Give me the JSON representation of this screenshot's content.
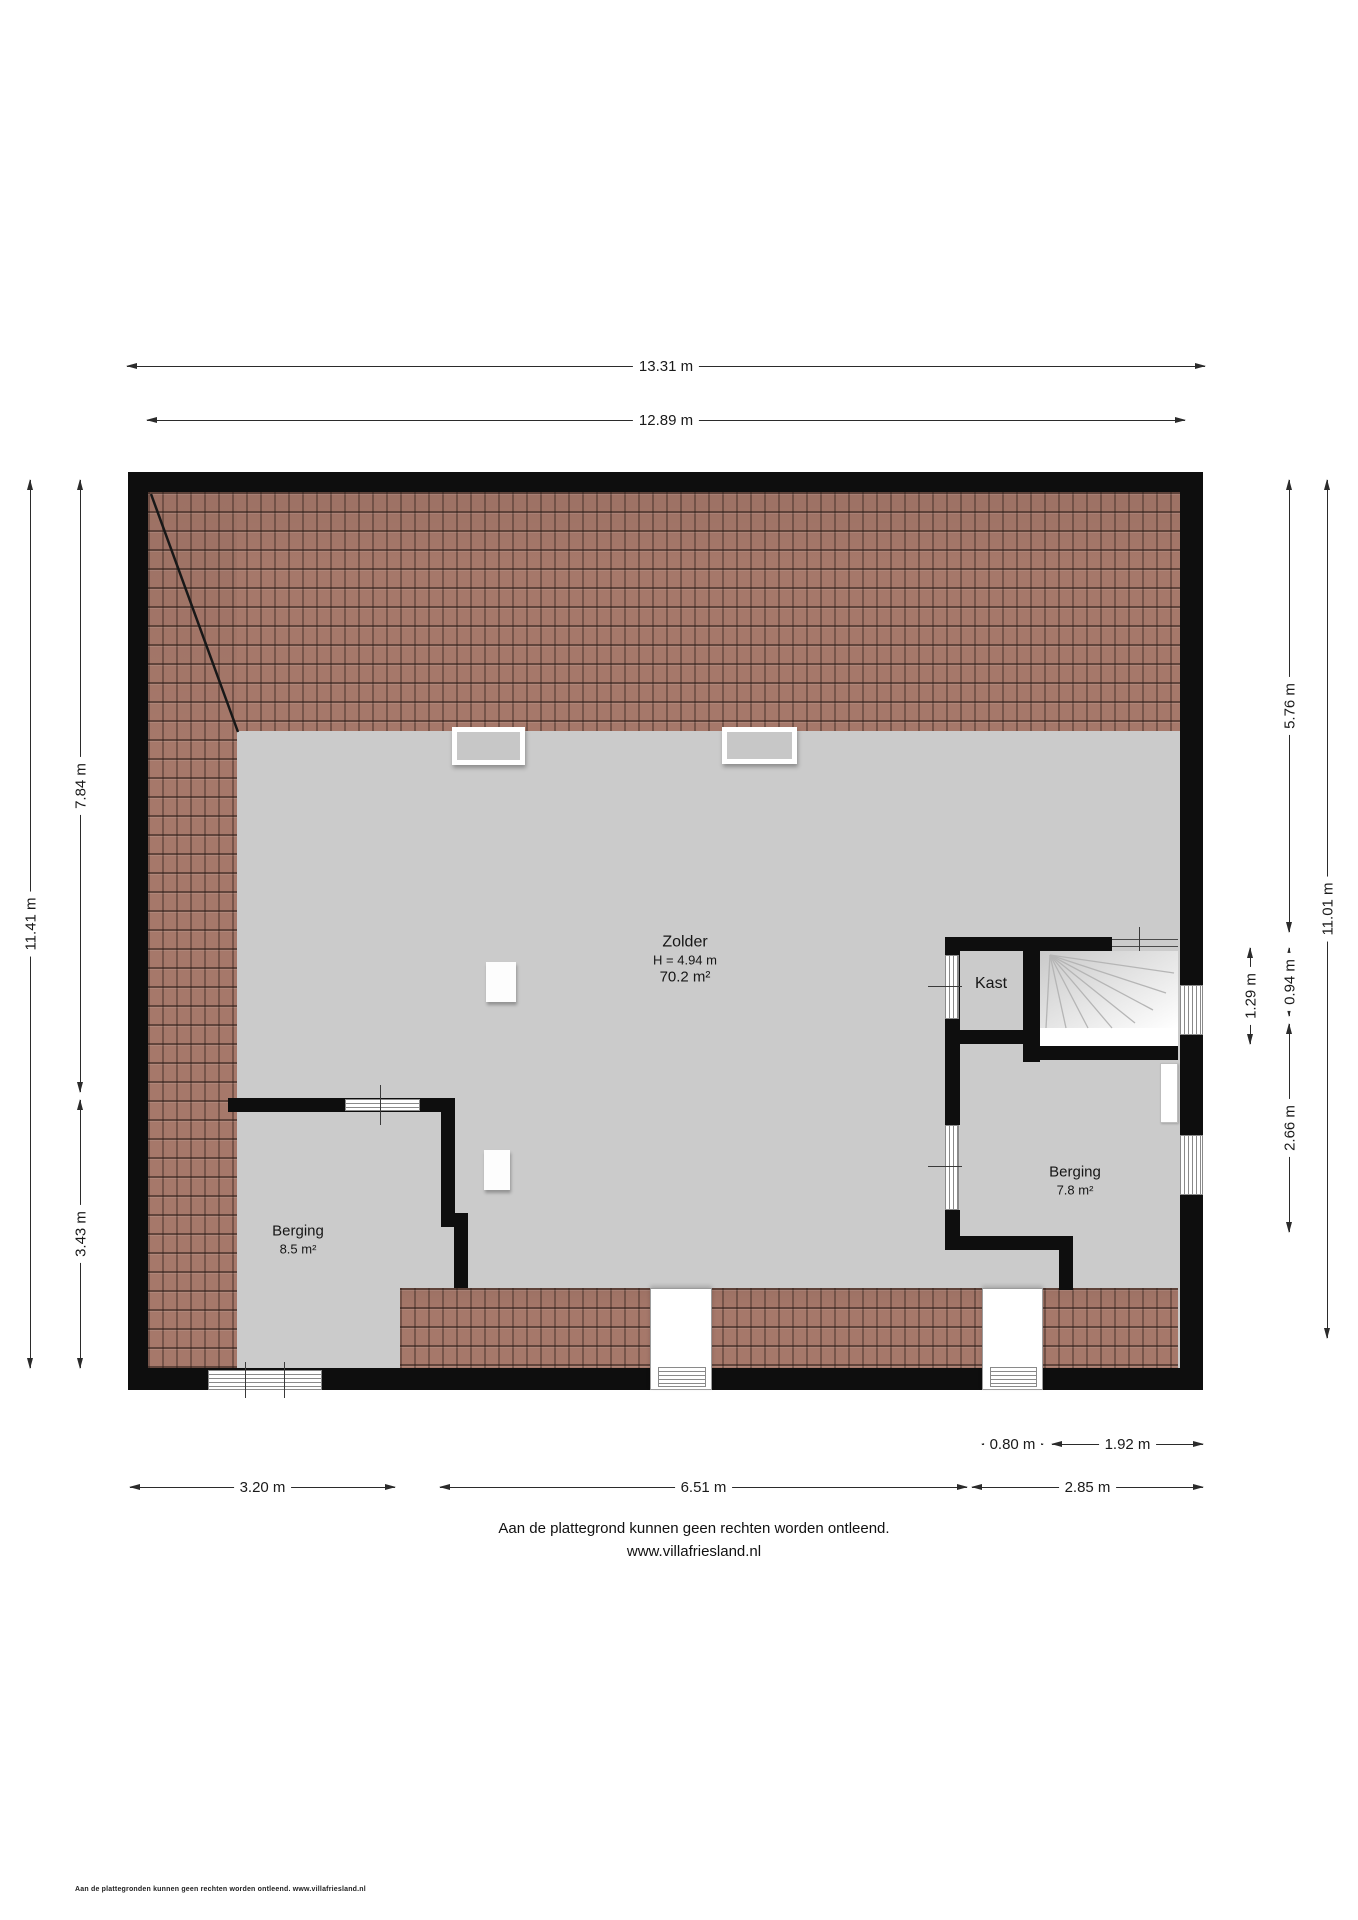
{
  "dimensions": {
    "top_outer": "13.31 m",
    "top_inner": "12.89 m",
    "left_total": "11.41 m",
    "left_upper": "7.84 m",
    "left_lower": "3.43 m",
    "right_upper": "5.76 m",
    "right_total": "11.01 m",
    "stair_bay": "1.29 m",
    "kast_depth": "0.94 m",
    "berging_right_height": "2.66 m",
    "bottom_dormer": "0.80 m",
    "bottom_window_span": "1.92 m",
    "bottom_left": "3.20 m",
    "bottom_middle": "6.51 m",
    "bottom_right": "2.85 m"
  },
  "rooms": {
    "zolder": {
      "name": "Zolder",
      "height": "H = 4.94 m",
      "area": "70.2 m²"
    },
    "kast": {
      "name": "Kast"
    },
    "berging_left": {
      "name": "Berging",
      "area": "8.5 m²"
    },
    "berging_right": {
      "name": "Berging",
      "area": "7.8 m²"
    }
  },
  "footer": {
    "disclaimer": "Aan de plattegrond kunnen geen rechten worden ontleend.",
    "website": "www.villafriesland.nl"
  },
  "corner_note": "Aan de plattegronden kunnen geen rechten worden ontleend. www.villafriesland.nl",
  "colors": {
    "wall": "#0e0e0e",
    "floor": "#cbcbcb",
    "roof_tiles": "#a6786a",
    "dimension_lines": "#2b2b2b"
  }
}
